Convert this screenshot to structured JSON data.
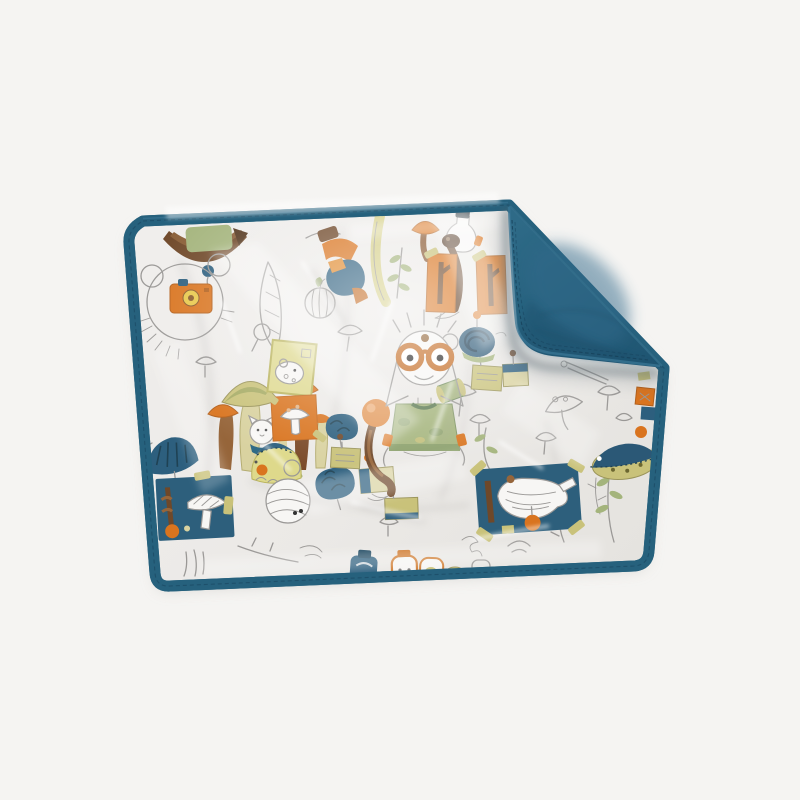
{
  "image": {
    "type": "product-photograph",
    "description": "Studio photo of a rectangular baby changing mat / blanket wrapped in glossy clear plastic. It has petrol-blue bound edges with stitching; the top-right corner is folded over, showing the plain petrol-blue quilted backing. The white fabric is printed with a nature-study pattern: a boy with big orange goggles and a green t-shirt, an upside-down child in orange trousers, clusters of orange and olive mushrooms, a mouse with an orange camera, blue specimen patches with white mushrooms taped like field samples, framed cards, pinned labels, blue coral leaves, jars, plants and many grey line-drawn sketches.",
    "background": "plain very light grey seamless background"
  },
  "colors": {
    "bg": "#f5f4f2",
    "teal": "#26617d",
    "teal-dark": "#1d4f6a",
    "teal-light": "#35708c",
    "fabric": "#edebe8",
    "fabric-deep": "#e3e1dd",
    "line": "#9a9896",
    "orange": "#d9741f",
    "orange-soft": "#e08a2e",
    "olive": "#c9c27a",
    "olive-deep": "#9a945a",
    "olive-pale": "#ded98b",
    "sage": "#a4b47c",
    "sage-deep": "#6f8a5a",
    "brown": "#6f4829",
    "brown-light": "#96653a",
    "blue": "#2d5f7e",
    "blue-deep": "#1f4254",
    "white-ink": "#f7f6f4",
    "shadow": "#55656e"
  },
  "motifs": [
    "boy with orange goggles and sage-green t-shirt",
    "upside-down child in orange trousers and blue jacket with striped apple",
    "brown acorn boat with green patch",
    "mouse face with orange camera",
    "cluster of orange and olive mushrooms with white kitten",
    "blue coral fan",
    "olive framed card with white mouse",
    "orange framed card with white mushroom",
    "blue brain-coral leaves",
    "pinned specimen labels",
    "round orange ball mushroom on curved brown stem",
    "dark blue ammonite snail with orange pin",
    "yellow snail-fish with blue crest",
    "white yarn-ball creature with eyes",
    "blue specimen patch with taped white mushroom (left)",
    "blue specimen patch with taped white oyster mushroom (right)",
    "orange tree cards",
    "glass flask with dark cap",
    "tall mushrooms and yellow stalk",
    "olive leaf sprigs",
    "blue and olive fish",
    "row of jars cut off at the bottom edge",
    "grey line-art sketches of mushrooms, plants and tools"
  ]
}
